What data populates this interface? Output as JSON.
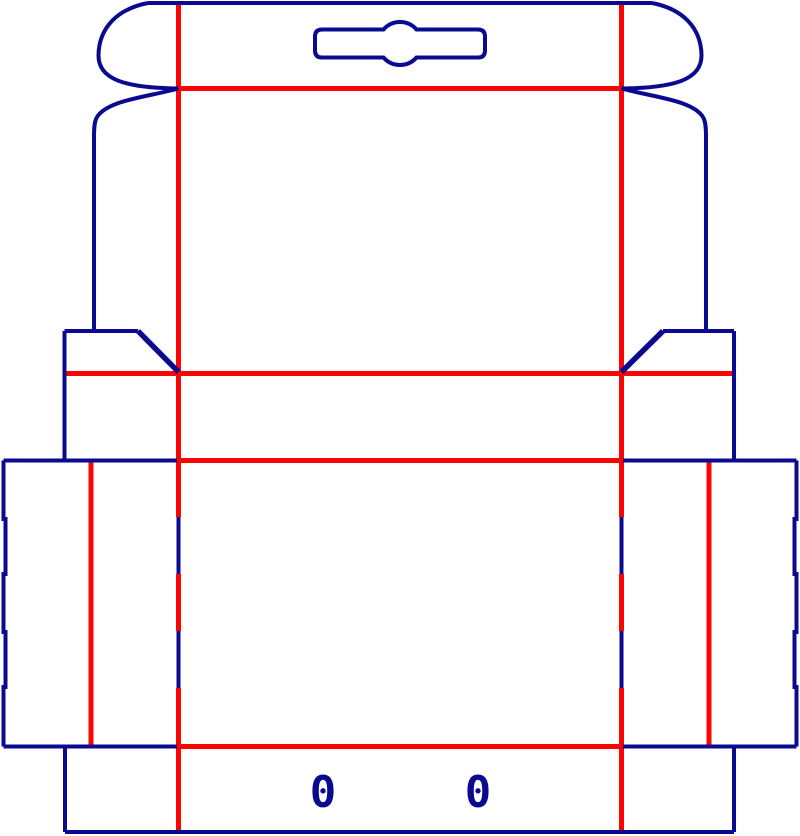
{
  "canvas": {
    "width": 800,
    "height": 836,
    "background": "#ffffff"
  },
  "style": {
    "cut_color": "#0a0a90",
    "crease_color": "#fb0404",
    "cut_stroke_width": 4,
    "crease_stroke_width": 5
  },
  "labels": {
    "zero_left": "0",
    "zero_right": "0"
  },
  "dieline": {
    "crease_segments": [
      [
        178.5,
        5,
        178.5,
        517
      ],
      [
        178.5,
        574,
        178.5,
        631
      ],
      [
        178.5,
        688,
        178.5,
        832
      ],
      [
        621.5,
        5,
        621.5,
        517
      ],
      [
        621.5,
        574,
        621.5,
        631
      ],
      [
        621.5,
        688,
        621.5,
        832
      ],
      [
        178.5,
        88.5,
        621.5,
        88.5
      ],
      [
        65,
        373.5,
        734,
        373.5
      ],
      [
        178.5,
        460.5,
        621.5,
        460.5
      ],
      [
        178.5,
        746.5,
        621.5,
        746.5
      ],
      [
        91,
        461,
        91,
        746
      ],
      [
        709,
        461,
        709,
        746
      ]
    ],
    "cut_segments": [
      [
        148,
        3,
        652,
        3
      ],
      [
        64.5,
        331,
        138,
        331
      ],
      [
        138,
        331,
        178.5,
        372,
        5.5
      ],
      [
        663,
        331,
        734,
        331
      ],
      [
        621.5,
        372,
        663,
        331,
        5.5
      ],
      [
        64.5,
        331,
        64.5,
        460.5
      ],
      [
        734,
        331,
        734,
        460.5
      ],
      [
        3.5,
        460.5,
        177,
        460.5
      ],
      [
        623,
        460.5,
        796.5,
        460.5
      ],
      [
        178.5,
        517,
        178.5,
        574
      ],
      [
        178.5,
        631,
        178.5,
        688
      ],
      [
        621.5,
        517,
        621.5,
        574
      ],
      [
        621.5,
        631,
        621.5,
        688
      ],
      [
        3.5,
        746.5,
        177,
        746.5
      ],
      [
        623,
        746.5,
        796.5,
        746.5
      ],
      [
        65,
        746.5,
        65,
        832
      ],
      [
        65,
        832,
        734,
        832
      ],
      [
        734,
        746.5,
        734,
        832
      ]
    ],
    "cut_paths": [
      "M 3.5 460.5 L 3.5 519 L 5.5 519 L 5.5 574 L 3.5 574 L 3.5 632 L 5.5 632 L 5.5 687 L 3.5 687 L 3.5 746.5",
      "M 796.5 460.5 L 796.5 519 L 794.5 519 L 794.5 574 L 796.5 574 L 796.5 632 L 794.5 632 L 794.5 687 L 796.5 687 L 796.5 746.5",
      "M 148 3 C 117 9 99 28 98.5 55 C 98 79 124 88 178.5 88.5",
      "M 652 3 C 683 9 701 28 701.5 55 C 702 79 676 88 621.5 88.5",
      "M 178.5 88.5 C 148 97 106 100 96.5 118 C 94.5 122 94 127 94 137 L 94 331",
      "M 621.5 88.5 C 652 97 694 100 703.5 118 C 705.5 122 706 127 706 137 L 706 331",
      "M 322 29.5 L 383.5 29.5 A 22 22 0 0 1 416.5 29.5 L 478 29.5 Q 485 29.5 485 36.5 L 485 50.5 Q 485 57.5 478 57.5 L 416.5 57.5 A 22 22 0 0 1 383.5 57.5 L 322 57.5 Q 315 57.5 315 50.5 L 315 36.5 Q 315 29.5 322 29.5 Z"
    ]
  }
}
